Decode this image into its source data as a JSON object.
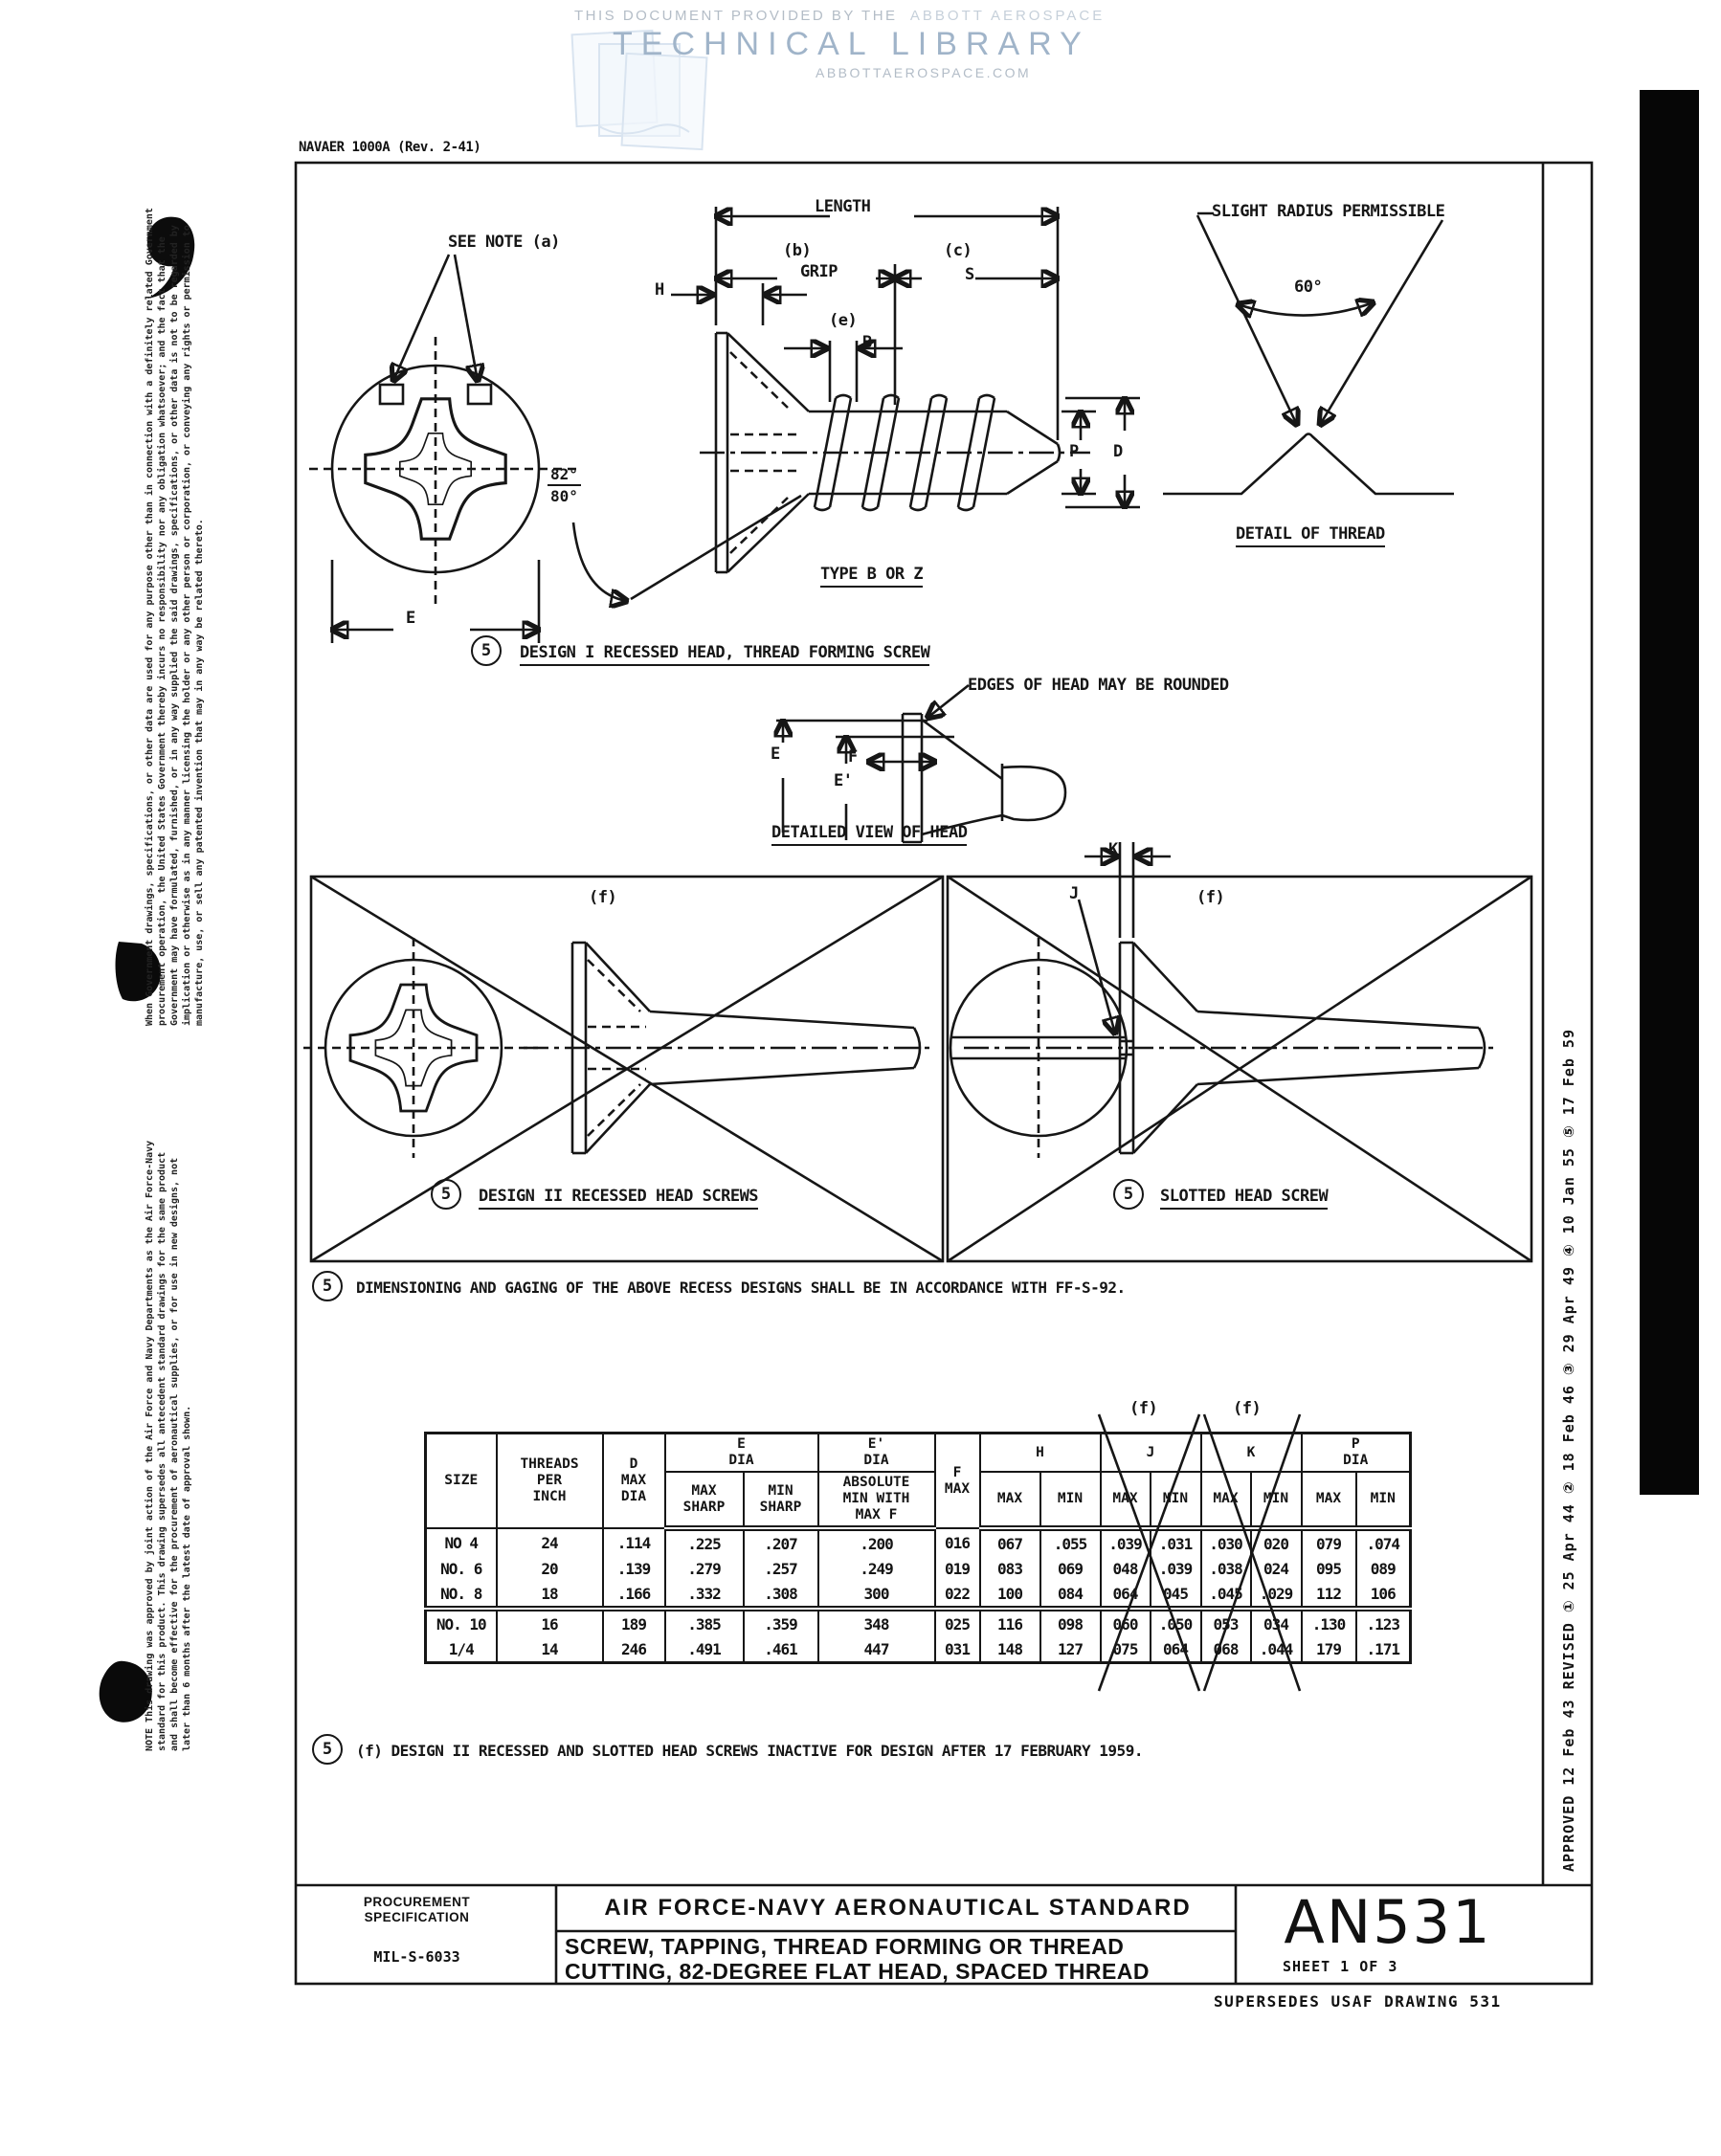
{
  "colors": {
    "ink": "#161616",
    "watermark_blue": "#a0b4c9",
    "paper": "#ffffff",
    "scan_bar": "#060606"
  },
  "watermark": {
    "provided_by": "THIS DOCUMENT PROVIDED BY THE",
    "brand": "ABBOTT AEROSPACE",
    "library": "TECHNICAL LIBRARY",
    "site": "ABBOTTAEROSPACE.COM"
  },
  "form_number": "NAVAER 1000A (Rev. 2-41)",
  "margin_notes": {
    "disclaimer": "When Government drawings, specifications, or other data are used for any purpose other than in connection with a definitely related Government procurement operation, the United States Government thereby incurs no responsibility nor any obligation whatsoever; and the fact that the Government may have formulated, furnished, or in any way supplied the said drawings, specifications, or other data is not to be regarded by implication or otherwise as in any manner licensing the holder or any other person or corporation, or conveying any rights or permission to manufacture, use, or sell any patented invention that may in any way be related thereto.",
    "note": "NOTE  This drawing was approved by joint action of the Air Force and Navy Departments as the Air Force-Navy standard for this product.  This drawing supersedes all antecedent standard drawings for the same product and shall become effective for the procurement of aeronautical supplies, or for use in new designs, not later than 6 months after the latest date of approval shown."
  },
  "labels": {
    "see_note": "SEE NOTE (a)",
    "length": "LENGTH",
    "b_tag": "(b)",
    "grip": "GRIP",
    "c_tag": "(c)",
    "s": "S",
    "h": "H",
    "e_tag": "(e)",
    "b": "B",
    "angle_top": "82°",
    "angle_bottom": "80°",
    "p": "P",
    "d": "D",
    "e_dim": "E",
    "type_b_or_z": "TYPE B OR Z",
    "design1_num": "5",
    "design1": "DESIGN I RECESSED HEAD, THREAD FORMING SCREW",
    "slight_radius": "SLIGHT RADIUS PERMISSIBLE",
    "sixty_deg": "60°",
    "detail_of_thread": "DETAIL OF THREAD",
    "edges_rounded": "EDGES OF HEAD MAY BE ROUNDED",
    "e2": "E",
    "e_prime": "E'",
    "f": "F",
    "detailed_view": "DETAILED VIEW OF HEAD",
    "f_tag_left": "(f)",
    "f_tag_right": "(f)",
    "k": "K",
    "j": "J",
    "design2_num": "5",
    "design2": "DESIGN II RECESSED HEAD SCREWS",
    "slotted_num": "5",
    "slotted": "SLOTTED HEAD SCREW",
    "gaging_num": "5",
    "gaging_note": "DIMENSIONING AND GAGING OF THE ABOVE RECESS DESIGNS SHALL BE IN ACCORDANCE WITH FF-S-92.",
    "footnote_num": "5",
    "footnote": "(f) DESIGN II RECESSED AND SLOTTED HEAD SCREWS INACTIVE FOR DESIGN AFTER 17 FEBRUARY 1959."
  },
  "table": {
    "f_tag_j": "(f)",
    "f_tag_k": "(f)",
    "headers": {
      "size": "SIZE",
      "tpi": "THREADS\nPER\nINCH",
      "d": "D\nMAX\nDIA",
      "e": "E\nDIA",
      "e_prime": "E'\nDIA",
      "max_sharp": "MAX\nSHARP",
      "min_sharp": "MIN\nSHARP",
      "abs_min": "ABSOLUTE\nMIN WITH\nMAX F",
      "f": "F\nMAX",
      "h": "H",
      "j": "J",
      "k": "K",
      "p": "P\nDIA",
      "max": "MAX",
      "min": "MIN"
    },
    "rows": [
      [
        "NO 4",
        "24",
        ".114",
        ".225",
        ".207",
        ".200",
        "016",
        "067",
        ".055",
        ".039",
        ".031",
        ".030",
        "020",
        "079",
        ".074"
      ],
      [
        "NO. 6",
        "20",
        ".139",
        ".279",
        ".257",
        ".249",
        "019",
        "083",
        "069",
        "048",
        ".039",
        ".038",
        "024",
        "095",
        "089"
      ],
      [
        "NO. 8",
        "18",
        ".166",
        ".332",
        ".308",
        "300",
        "022",
        "100",
        "084",
        "064",
        "045",
        ".045",
        ".029",
        "112",
        "106"
      ],
      [
        "NO. 10",
        "16",
        "189",
        ".385",
        ".359",
        "348",
        "025",
        "116",
        "098",
        "060",
        ".050",
        "053",
        "034",
        ".130",
        ".123"
      ],
      [
        "1/4",
        "14",
        "246",
        ".491",
        ".461",
        "447",
        "031",
        "148",
        "127",
        "075",
        "064",
        "068",
        ".044",
        "179",
        ".171"
      ]
    ]
  },
  "title_block": {
    "procurement": "PROCUREMENT\nSPECIFICATION",
    "spec": "MIL-S-6033",
    "standard": "AIR FORCE-NAVY AERONAUTICAL STANDARD",
    "title_line1": "SCREW, TAPPING, THREAD FORMING OR THREAD",
    "title_line2": "CUTTING, 82-DEGREE FLAT HEAD, SPACED THREAD",
    "number": "AN531",
    "sheet": "SHEET 1 OF 3",
    "supersedes": "SUPERSEDES USAF DRAWING 531"
  },
  "revisions": {
    "line": "APPROVED 12 Feb 43       REVISED    ①  25 Apr 44     ②  18 Feb 46     ③  29 Apr 49     ④  10 Jan 55     ⑤  17 Feb 59",
    "approved": "APPROVED 12 Feb 43",
    "revised_label": "REVISED",
    "entries": [
      {
        "num": "1",
        "date": "25 Apr 44"
      },
      {
        "num": "2",
        "date": "18 Feb 46"
      },
      {
        "num": "3",
        "date": "29 Apr 49"
      },
      {
        "num": "4",
        "date": "10 Jan 55"
      },
      {
        "num": "5",
        "date": "17 Feb 59"
      }
    ]
  }
}
